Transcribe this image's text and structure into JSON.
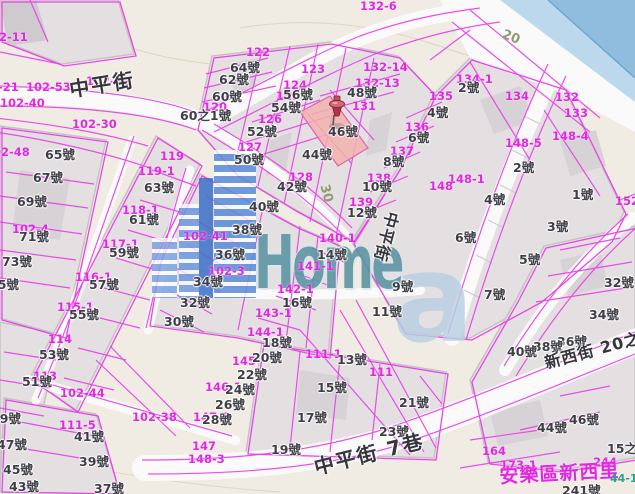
{
  "map": {
    "watermark": {
      "logo_text": "Home",
      "logo_letter": "a"
    },
    "colors": {
      "parcel_line": "#e83ee8",
      "parcel_label": "#e327e3",
      "highlight_parcel": "#f2b1ae",
      "water": "#93bfdd",
      "pin": "#b03448",
      "watermark_blue": "#5e8fd8",
      "watermark_teal": "#5d95a3"
    },
    "street_labels": [
      {
        "text": "中平街",
        "x": 68,
        "y": 80,
        "rot": -9,
        "cls": "street"
      },
      {
        "text": "中平街 7巷",
        "x": 312,
        "y": 458,
        "rot": -14,
        "cls": "street"
      },
      {
        "text": "新西街 20之",
        "x": 543,
        "y": 356,
        "rot": -15,
        "cls": "street-sm"
      },
      {
        "text": "安樂區新西里",
        "x": 499,
        "y": 468,
        "rot": -3,
        "cls": "street-magenta"
      },
      {
        "text": "中平街",
        "x": 400,
        "y": 214,
        "rot": 105,
        "cls": "street-sm"
      },
      {
        "text": "30",
        "x": 330,
        "y": 183,
        "rot": 75,
        "cls": "roadnum"
      },
      {
        "text": "20",
        "x": 505,
        "y": 28,
        "rot": 22,
        "cls": "roadnum"
      },
      {
        "text": "44-1",
        "x": 610,
        "y": 473,
        "rot": 0,
        "cls": "teal"
      }
    ],
    "parcel_labels": [
      {
        "text": "132-6",
        "x": 360,
        "y": 1
      },
      {
        "text": "102-11",
        "x": -17,
        "y": 32
      },
      {
        "text": "102-52",
        "x": 86,
        "y": 76
      },
      {
        "text": "102-21",
        "x": -26,
        "y": 82
      },
      {
        "text": "102-53",
        "x": 26,
        "y": 82
      },
      {
        "text": "102-40",
        "x": 0,
        "y": 98
      },
      {
        "text": "102-30",
        "x": 72,
        "y": 119
      },
      {
        "text": "102-48",
        "x": -15,
        "y": 147
      },
      {
        "text": "122",
        "x": 246,
        "y": 47
      },
      {
        "text": "123",
        "x": 301,
        "y": 64
      },
      {
        "text": "124",
        "x": 283,
        "y": 80
      },
      {
        "text": "125",
        "x": 276,
        "y": 91
      },
      {
        "text": "126",
        "x": 258,
        "y": 114
      },
      {
        "text": "127",
        "x": 238,
        "y": 142
      },
      {
        "text": "128",
        "x": 289,
        "y": 172
      },
      {
        "text": "120",
        "x": 203,
        "y": 102
      },
      {
        "text": "132-14",
        "x": 363,
        "y": 62
      },
      {
        "text": "132-13",
        "x": 355,
        "y": 78
      },
      {
        "text": "131",
        "x": 352,
        "y": 101
      },
      {
        "text": "134-1",
        "x": 456,
        "y": 74
      },
      {
        "text": "135",
        "x": 429,
        "y": 91
      },
      {
        "text": "134",
        "x": 505,
        "y": 91
      },
      {
        "text": "132",
        "x": 555,
        "y": 92
      },
      {
        "text": "133",
        "x": 564,
        "y": 108
      },
      {
        "text": "136",
        "x": 405,
        "y": 122
      },
      {
        "text": "137",
        "x": 390,
        "y": 146
      },
      {
        "text": "138",
        "x": 367,
        "y": 173
      },
      {
        "text": "139",
        "x": 349,
        "y": 197
      },
      {
        "text": "148-1",
        "x": 448,
        "y": 174
      },
      {
        "text": "148",
        "x": 429,
        "y": 181
      },
      {
        "text": "148-4",
        "x": 552,
        "y": 131
      },
      {
        "text": "148-5",
        "x": 505,
        "y": 138
      },
      {
        "text": "152",
        "x": 615,
        "y": 196
      },
      {
        "text": "119",
        "x": 160,
        "y": 151
      },
      {
        "text": "119-1",
        "x": 138,
        "y": 166
      },
      {
        "text": "118-1",
        "x": 122,
        "y": 205
      },
      {
        "text": "117-1",
        "x": 102,
        "y": 239
      },
      {
        "text": "116-1",
        "x": 75,
        "y": 272
      },
      {
        "text": "115-1",
        "x": 57,
        "y": 302
      },
      {
        "text": "114",
        "x": 48,
        "y": 334
      },
      {
        "text": "113",
        "x": 33,
        "y": 371
      },
      {
        "text": "102-4",
        "x": 12,
        "y": 224
      },
      {
        "text": "102-41",
        "x": 183,
        "y": 231
      },
      {
        "text": "102-3",
        "x": 208,
        "y": 266
      },
      {
        "text": "140-1",
        "x": 319,
        "y": 233
      },
      {
        "text": "141-1",
        "x": 297,
        "y": 261
      },
      {
        "text": "142-1",
        "x": 277,
        "y": 284
      },
      {
        "text": "143-1",
        "x": 255,
        "y": 308
      },
      {
        "text": "144-1",
        "x": 247,
        "y": 327
      },
      {
        "text": "145",
        "x": 232,
        "y": 356
      },
      {
        "text": "146-1",
        "x": 205,
        "y": 382
      },
      {
        "text": "147-1",
        "x": 193,
        "y": 412
      },
      {
        "text": "111-1",
        "x": 305,
        "y": 349
      },
      {
        "text": "111",
        "x": 369,
        "y": 367
      },
      {
        "text": "111-5",
        "x": 59,
        "y": 420
      },
      {
        "text": "102-44",
        "x": 60,
        "y": 388
      },
      {
        "text": "102-38",
        "x": 132,
        "y": 412
      },
      {
        "text": "147",
        "x": 192,
        "y": 441
      },
      {
        "text": "148-3",
        "x": 188,
        "y": 454
      },
      {
        "text": "164",
        "x": 482,
        "y": 446
      },
      {
        "text": "173-1",
        "x": 500,
        "y": 460
      },
      {
        "text": "244",
        "x": 593,
        "y": 457
      }
    ],
    "house_labels": [
      {
        "text": "64號",
        "x": 230,
        "y": 62
      },
      {
        "text": "62號",
        "x": 219,
        "y": 74
      },
      {
        "text": "60號",
        "x": 212,
        "y": 91
      },
      {
        "text": "60之1號",
        "x": 180,
        "y": 110
      },
      {
        "text": "56號",
        "x": 283,
        "y": 89
      },
      {
        "text": "54號",
        "x": 271,
        "y": 102
      },
      {
        "text": "52號",
        "x": 247,
        "y": 126
      },
      {
        "text": "50號",
        "x": 234,
        "y": 154
      },
      {
        "text": "48號",
        "x": 347,
        "y": 87
      },
      {
        "text": "46號",
        "x": 328,
        "y": 126
      },
      {
        "text": "44號",
        "x": 302,
        "y": 149
      },
      {
        "text": "42號",
        "x": 277,
        "y": 181
      },
      {
        "text": "40號",
        "x": 249,
        "y": 201
      },
      {
        "text": "38號",
        "x": 232,
        "y": 224
      },
      {
        "text": "36號",
        "x": 215,
        "y": 249
      },
      {
        "text": "34號",
        "x": 193,
        "y": 276
      },
      {
        "text": "32號",
        "x": 180,
        "y": 297
      },
      {
        "text": "30號",
        "x": 164,
        "y": 316
      },
      {
        "text": "65號",
        "x": 45,
        "y": 149
      },
      {
        "text": "67號",
        "x": 33,
        "y": 172
      },
      {
        "text": "69號",
        "x": 17,
        "y": 196
      },
      {
        "text": "71號",
        "x": 19,
        "y": 231
      },
      {
        "text": "73號",
        "x": 2,
        "y": 256
      },
      {
        "text": "75號",
        "x": -11,
        "y": 279
      },
      {
        "text": "63號",
        "x": 144,
        "y": 182
      },
      {
        "text": "61號",
        "x": 129,
        "y": 214
      },
      {
        "text": "59號",
        "x": 109,
        "y": 247
      },
      {
        "text": "57號",
        "x": 89,
        "y": 279
      },
      {
        "text": "55號",
        "x": 69,
        "y": 309
      },
      {
        "text": "53號",
        "x": 39,
        "y": 349
      },
      {
        "text": "51號",
        "x": 22,
        "y": 376
      },
      {
        "text": "49號",
        "x": -9,
        "y": 413
      },
      {
        "text": "47號",
        "x": -3,
        "y": 439
      },
      {
        "text": "45號",
        "x": 3,
        "y": 464
      },
      {
        "text": "43號",
        "x": 9,
        "y": 481
      },
      {
        "text": "41號",
        "x": 74,
        "y": 431
      },
      {
        "text": "39號",
        "x": 79,
        "y": 456
      },
      {
        "text": "37號",
        "x": 94,
        "y": 483
      },
      {
        "text": "2號",
        "x": 458,
        "y": 82
      },
      {
        "text": "4號",
        "x": 427,
        "y": 107
      },
      {
        "text": "6號",
        "x": 408,
        "y": 132
      },
      {
        "text": "8號",
        "x": 383,
        "y": 156
      },
      {
        "text": "10號",
        "x": 362,
        "y": 181
      },
      {
        "text": "12號",
        "x": 347,
        "y": 207
      },
      {
        "text": "14號",
        "x": 317,
        "y": 249
      },
      {
        "text": "16號",
        "x": 282,
        "y": 297
      },
      {
        "text": "18號",
        "x": 262,
        "y": 337
      },
      {
        "text": "20號",
        "x": 252,
        "y": 352
      },
      {
        "text": "22號",
        "x": 237,
        "y": 369
      },
      {
        "text": "24號",
        "x": 225,
        "y": 384
      },
      {
        "text": "26號",
        "x": 215,
        "y": 399
      },
      {
        "text": "28號",
        "x": 202,
        "y": 414
      },
      {
        "text": "2號",
        "x": 513,
        "y": 162
      },
      {
        "text": "4號",
        "x": 484,
        "y": 194
      },
      {
        "text": "6號",
        "x": 455,
        "y": 232
      },
      {
        "text": "1號",
        "x": 572,
        "y": 189
      },
      {
        "text": "3號",
        "x": 547,
        "y": 221
      },
      {
        "text": "5號",
        "x": 519,
        "y": 254
      },
      {
        "text": "7號",
        "x": 484,
        "y": 289
      },
      {
        "text": "9號",
        "x": 392,
        "y": 281
      },
      {
        "text": "11號",
        "x": 372,
        "y": 306
      },
      {
        "text": "13號",
        "x": 337,
        "y": 354
      },
      {
        "text": "15號",
        "x": 317,
        "y": 382
      },
      {
        "text": "17號",
        "x": 297,
        "y": 412
      },
      {
        "text": "19號",
        "x": 271,
        "y": 444
      },
      {
        "text": "21號",
        "x": 399,
        "y": 397
      },
      {
        "text": "23號",
        "x": 379,
        "y": 426
      },
      {
        "text": "32號",
        "x": 604,
        "y": 277
      },
      {
        "text": "34號",
        "x": 589,
        "y": 309
      },
      {
        "text": "36號",
        "x": 557,
        "y": 336
      },
      {
        "text": "38號",
        "x": 533,
        "y": 341
      },
      {
        "text": "40號",
        "x": 507,
        "y": 346
      },
      {
        "text": "44號",
        "x": 537,
        "y": 422
      },
      {
        "text": "46號",
        "x": 569,
        "y": 414
      },
      {
        "text": "15之",
        "x": 607,
        "y": 443
      },
      {
        "text": "241號",
        "x": 562,
        "y": 485
      }
    ]
  }
}
